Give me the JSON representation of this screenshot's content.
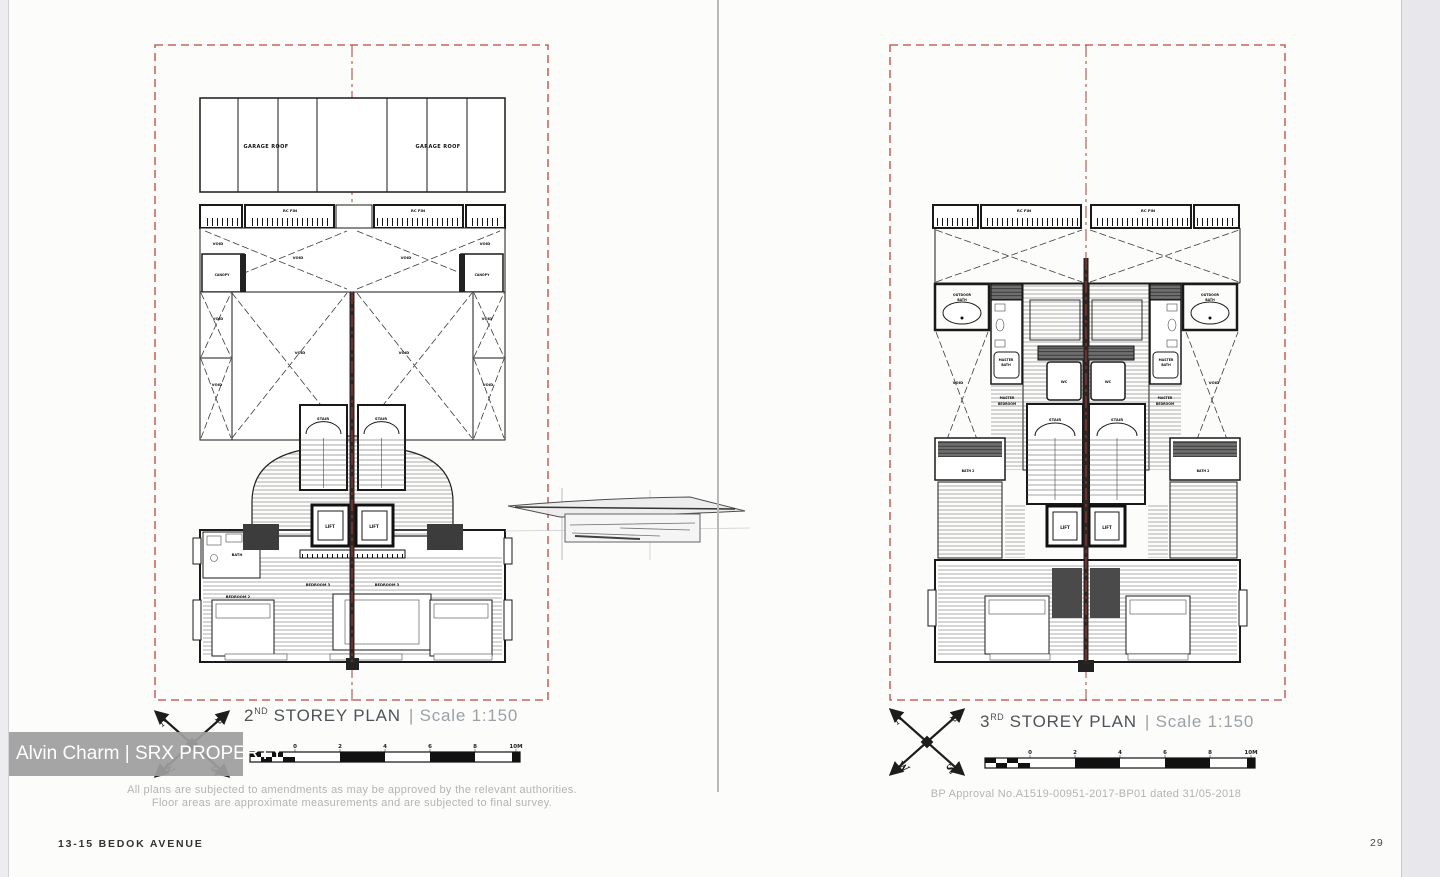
{
  "page": {
    "watermark": "Alvin Charm | SRX PROPERTY",
    "footer_left": "13-15 BEDOK AVENUE",
    "page_number": "29"
  },
  "compass": {
    "n": "N",
    "e": "E",
    "s": "S",
    "w": "W"
  },
  "scalebar": {
    "ticks": [
      "0",
      "2",
      "4",
      "6",
      "8",
      "10M"
    ]
  },
  "left_plan": {
    "title": {
      "number": "2",
      "ordinal": "ND",
      "name": " STOREY PLAN",
      "separator": "|",
      "scale": "Scale 1:150"
    },
    "note_line1": "All plans are subjected to amendments as may be approved by the relevant authorities.",
    "note_line2": "Floor areas are approximate measurements and are subjected to final survey."
  },
  "right_plan": {
    "title": {
      "number": "3",
      "ordinal": "RD",
      "name": " STOREY PLAN",
      "separator": "|",
      "scale": "Scale 1:150"
    },
    "approval_note": "BP Approval No.A1519-00951-2017-BP01 dated 31/05-2018"
  },
  "room_labels": {
    "garage_roof": "GARAGE ROOF",
    "rc_fin": "RC FIN",
    "void": "VOID",
    "canopy": "CANOPY",
    "stair": "STAIR",
    "lift": "LIFT",
    "bath": "BATH",
    "bedroom_2": "BEDROOM 2",
    "bedroom_3": "BEDROOM 3",
    "outdoor": "OUTDOOR",
    "bath_word": "BATH",
    "master": "MASTER",
    "bedroom_word": "BEDROOM",
    "wc": "WC",
    "bath_2": "BATH 2"
  },
  "colors": {
    "boundary_red": "#c0453d",
    "centerline_red": "#a84036",
    "party_wall": "#2e2424",
    "watermark_bg": "#9e9e9e",
    "note_gray": "#b4b4b4",
    "title_gray": "#4e5358"
  }
}
